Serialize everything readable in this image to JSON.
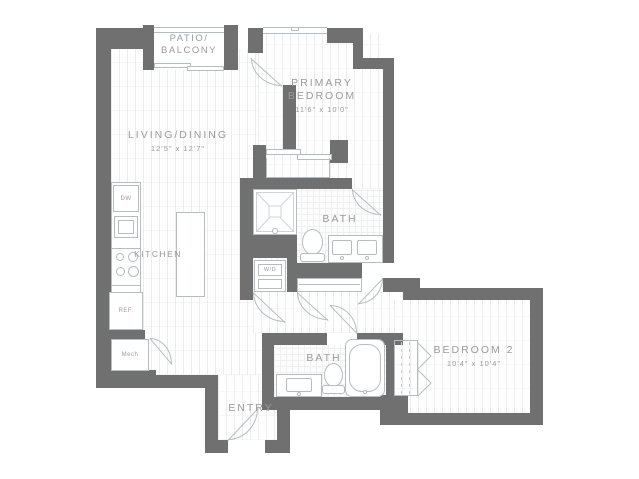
{
  "rooms": {
    "patio": {
      "line1": "PATIO/",
      "line2": "BALCONY"
    },
    "living": {
      "name": "LIVING/DINING",
      "dims": "12'5\" x 12'7\""
    },
    "kitchen": {
      "name": "KITCHEN"
    },
    "primary_bedroom": {
      "line1": "PRIMARY",
      "line2": "BEDROOM",
      "dims": "11'6\" x 10'0\""
    },
    "primary_bath": {
      "name": "BATH"
    },
    "hall_bath": {
      "name": "BATH"
    },
    "bedroom2": {
      "name": "BEDROOM 2",
      "dims": "10'4\" x 10'4\""
    },
    "entry": {
      "name": "ENTRY"
    }
  },
  "appliances": {
    "dishwasher": "DW",
    "refrigerator": "REF.",
    "washer_dryer": "W/D",
    "mechanical": "Mech"
  },
  "colors": {
    "wall": "#707070",
    "fixture_line": "#b7bcc1",
    "label_text": "#9b9b9b"
  }
}
